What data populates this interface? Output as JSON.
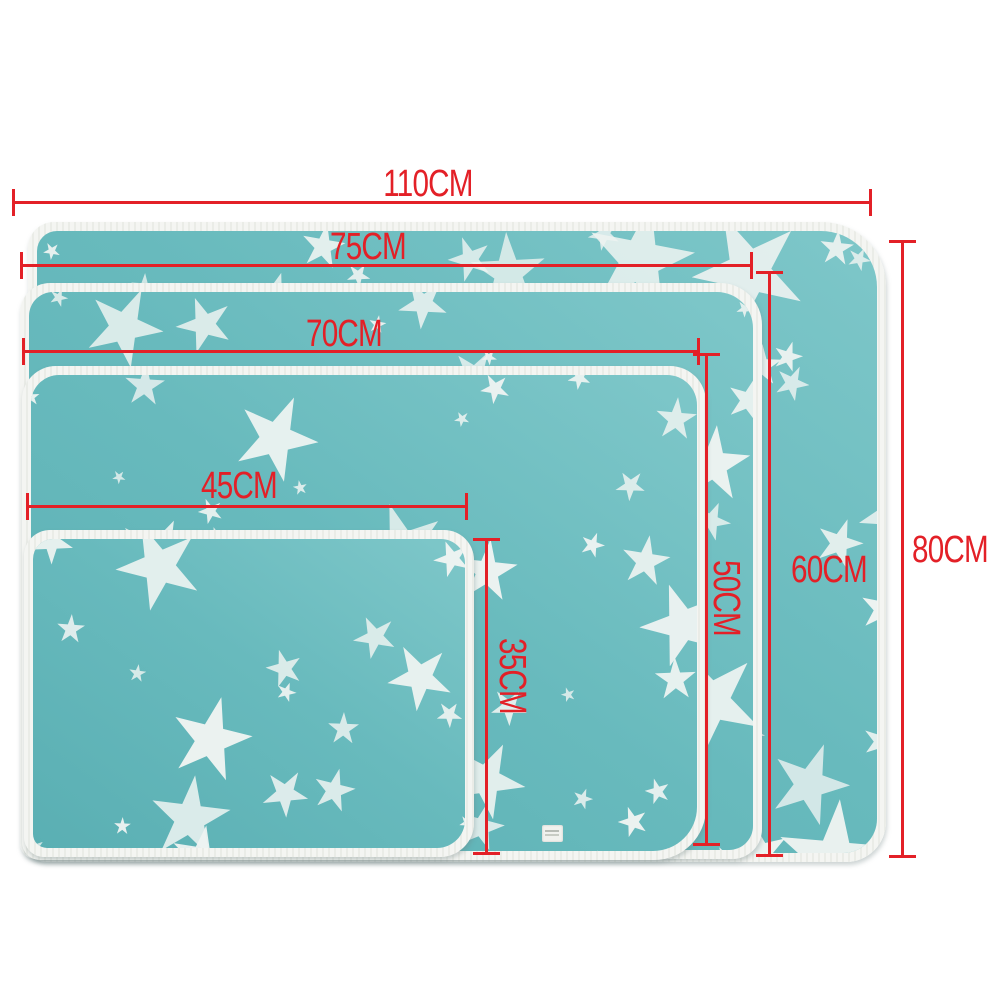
{
  "diagram": {
    "type": "product-size-diagram",
    "unit": "CM",
    "colors": {
      "dimension_red": "#e32027",
      "mat_teal": "#68babd",
      "mat_teal_light": "#7ec7c9",
      "mat_teal_dark": "#5aafb3",
      "star_white": "#edf3f1",
      "binding_white": "#f2f3ef",
      "background": "#ffffff"
    },
    "icons": {
      "star_pattern": "five-point-star",
      "care_label_tag": "small sewn fabric tag"
    },
    "sizes": [
      {
        "name": "size-110x80",
        "width_cm": 110,
        "height_cm": 80,
        "width_label": "110CM",
        "height_label": "80CM"
      },
      {
        "name": "size-75x60",
        "width_cm": 75,
        "height_cm": 60,
        "width_label": "75CM",
        "height_label": "60CM"
      },
      {
        "name": "size-70x50",
        "width_cm": 70,
        "height_cm": 50,
        "width_label": "70CM",
        "height_label": "50CM"
      },
      {
        "name": "size-45x35",
        "width_cm": 45,
        "height_cm": 35,
        "width_label": "45CM",
        "height_label": "35CM"
      }
    ]
  }
}
